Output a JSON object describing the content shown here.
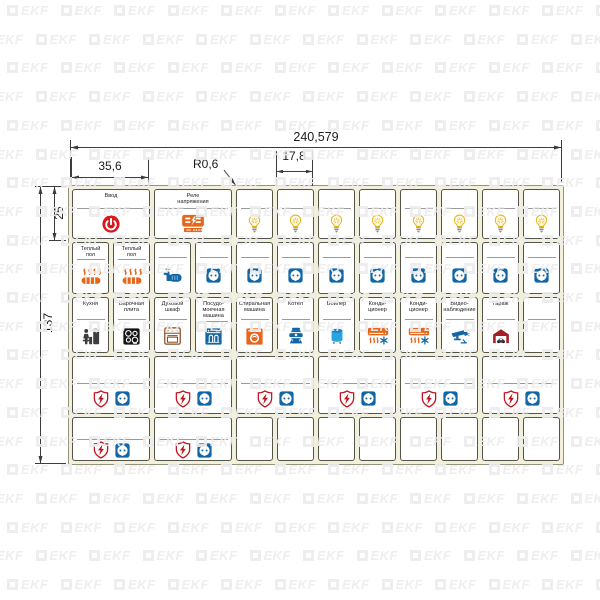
{
  "watermark": {
    "text": "EKF"
  },
  "dimensions": {
    "total_width": "240,579",
    "wide_label_width": "35,6",
    "corner_radius": "R0,6",
    "narrow_label_width": "17,8",
    "row1_height": "25",
    "total_height": "137"
  },
  "colors": {
    "red": "#d6181f",
    "shield_red": "#c1121c",
    "orange": "#e8661a",
    "blue": "#1266a5",
    "light_blue": "#2ba3dc",
    "dark_blue": "#1884c7",
    "bulb_yellow": "#e7b416",
    "black": "#141414",
    "brown": "#8a4a1f",
    "garage_red": "#a31f24",
    "gray": "#9a9a9a",
    "sheet_bg": "#f2efda",
    "watermark_gray": "#ededed"
  },
  "sheet": {
    "rows": [
      {
        "id": "row-1",
        "labels": [
          {
            "id": "main-input",
            "size": "wide",
            "text": "Ввод",
            "icons": [
              "power"
            ]
          },
          {
            "id": "voltage-relay",
            "size": "wide",
            "text": "Реле\nнапряжения",
            "icons": [
              "voltage-relay"
            ]
          },
          {
            "id": "light-1",
            "icons": [
              "bulb"
            ]
          },
          {
            "id": "light-2",
            "icons": [
              "bulb"
            ]
          },
          {
            "id": "light-3",
            "icons": [
              "bulb"
            ]
          },
          {
            "id": "light-4",
            "icons": [
              "bulb"
            ]
          },
          {
            "id": "light-5",
            "icons": [
              "bulb"
            ]
          },
          {
            "id": "light-6",
            "icons": [
              "bulb"
            ]
          },
          {
            "id": "light-7",
            "icons": [
              "bulb"
            ]
          },
          {
            "id": "light-8",
            "icons": [
              "bulb"
            ]
          }
        ]
      },
      {
        "id": "row-2",
        "labels": [
          {
            "id": "warm-floor-1",
            "text": "Теплый\nпол",
            "icons": [
              "warm-floor"
            ]
          },
          {
            "id": "warm-floor-2",
            "text": "Теплый\nпол",
            "icons": [
              "warm-floor"
            ]
          },
          {
            "id": "pump",
            "icons": [
              "pump"
            ]
          },
          {
            "id": "socket-1",
            "icons": [
              "socket"
            ]
          },
          {
            "id": "socket-2",
            "icons": [
              "socket"
            ]
          },
          {
            "id": "socket-3",
            "icons": [
              "socket"
            ]
          },
          {
            "id": "socket-4",
            "icons": [
              "socket"
            ]
          },
          {
            "id": "socket-5",
            "icons": [
              "socket"
            ]
          },
          {
            "id": "socket-6",
            "icons": [
              "socket"
            ]
          },
          {
            "id": "socket-7",
            "icons": [
              "socket"
            ]
          },
          {
            "id": "socket-8",
            "icons": [
              "socket"
            ]
          },
          {
            "id": "socket-9",
            "icons": [
              "socket"
            ]
          }
        ]
      },
      {
        "id": "row-3",
        "labels": [
          {
            "id": "kitchen",
            "text": "Кухня",
            "icons": [
              "kitchen"
            ]
          },
          {
            "id": "hob",
            "text": "Варочная\nплита",
            "icons": [
              "hob"
            ]
          },
          {
            "id": "oven",
            "text": "Духовой\nшкаф",
            "icons": [
              "oven"
            ]
          },
          {
            "id": "dishwasher",
            "text": "Посудо-\nмоечная\nмашина",
            "icons": [
              "dishwasher"
            ]
          },
          {
            "id": "washing-machine",
            "text": "Стиральная\nмашина",
            "icons": [
              "washing-machine"
            ]
          },
          {
            "id": "heating-boiler",
            "text": "Котел",
            "icons": [
              "heating-boiler"
            ]
          },
          {
            "id": "water-heater",
            "text": "Бойлер",
            "icons": [
              "water-heater"
            ]
          },
          {
            "id": "air-conditioner-1",
            "text": "Конди-\nционер",
            "icons": [
              "air-conditioner"
            ]
          },
          {
            "id": "air-conditioner-2",
            "text": "Конди-\nционер",
            "icons": [
              "air-conditioner"
            ]
          },
          {
            "id": "cctv",
            "text": "Видео-\nнаблюдение",
            "icons": [
              "cctv"
            ]
          },
          {
            "id": "garage",
            "text": "Гараж",
            "icons": [
              "garage"
            ]
          },
          {
            "id": "spare-1",
            "icons": []
          }
        ]
      },
      {
        "id": "row-4",
        "labels": [
          {
            "id": "protected-socket-1",
            "size": "wide",
            "icons": [
              "shield",
              "socket"
            ]
          },
          {
            "id": "protected-socket-2",
            "size": "wide",
            "icons": [
              "shield",
              "socket"
            ]
          },
          {
            "id": "protected-socket-3",
            "size": "wide",
            "icons": [
              "shield",
              "socket"
            ]
          },
          {
            "id": "protected-socket-4",
            "size": "wide",
            "icons": [
              "shield",
              "socket"
            ]
          },
          {
            "id": "protected-socket-5",
            "size": "wide",
            "icons": [
              "shield",
              "socket"
            ]
          },
          {
            "id": "protected-socket-6",
            "size": "wide",
            "icons": [
              "shield",
              "socket"
            ]
          }
        ]
      },
      {
        "id": "row-5",
        "labels": [
          {
            "id": "protected-socket-7",
            "size": "wide",
            "icons": [
              "shield",
              "socket"
            ]
          },
          {
            "id": "protected-socket-8",
            "size": "wide",
            "icons": [
              "shield",
              "socket"
            ]
          },
          {
            "id": "spare-2",
            "icons": [],
            "divider": false
          },
          {
            "id": "spare-3",
            "icons": [],
            "divider": false
          },
          {
            "id": "spare-4",
            "icons": [],
            "divider": false
          },
          {
            "id": "spare-5",
            "icons": [],
            "divider": false
          },
          {
            "id": "spare-6",
            "icons": [],
            "divider": false
          },
          {
            "id": "spare-7",
            "icons": [],
            "divider": false
          },
          {
            "id": "spare-8",
            "icons": [],
            "divider": false
          },
          {
            "id": "spare-9",
            "icons": [],
            "divider": false
          }
        ]
      }
    ]
  }
}
